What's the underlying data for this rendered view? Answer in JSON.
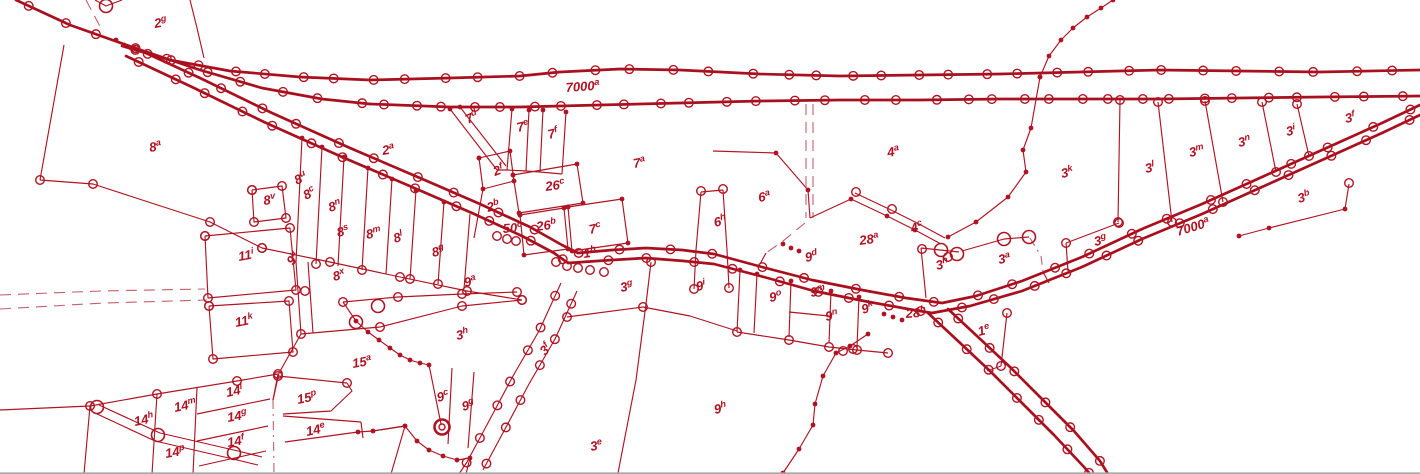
{
  "map": {
    "colors": {
      "background": "#ffffff",
      "line": "#a8101e",
      "thin": "#b01422",
      "dashed": "#c4616c",
      "text": "#b01323",
      "bottom_edge": "#a6a6a6"
    },
    "labels": [
      {
        "b": "2",
        "s": "g",
        "x": 155,
        "y": 28,
        "r": -10
      },
      {
        "b": "8",
        "s": "a",
        "x": 150,
        "y": 152,
        "r": -10
      },
      {
        "b": "2",
        "s": "a",
        "x": 383,
        "y": 155,
        "r": -10
      },
      {
        "b": "7",
        "s": "d",
        "x": 468,
        "y": 124,
        "r": -26
      },
      {
        "b": "7",
        "s": "e",
        "x": 518,
        "y": 132,
        "r": -14
      },
      {
        "b": "7",
        "s": "f",
        "x": 549,
        "y": 139,
        "r": -14
      },
      {
        "b": "7000",
        "s": "a",
        "x": 566,
        "y": 92,
        "r": -4,
        "fs": 14.5
      },
      {
        "b": "7",
        "s": "a",
        "x": 634,
        "y": 168,
        "r": -10
      },
      {
        "b": "4",
        "s": "a",
        "x": 888,
        "y": 157,
        "r": -10
      },
      {
        "b": "3",
        "s": "k",
        "x": 1062,
        "y": 178,
        "r": -12
      },
      {
        "b": "3",
        "s": "l",
        "x": 1146,
        "y": 173,
        "r": -12
      },
      {
        "b": "3",
        "s": "m",
        "x": 1190,
        "y": 157,
        "r": -12
      },
      {
        "b": "3",
        "s": "n",
        "x": 1239,
        "y": 147,
        "r": -12
      },
      {
        "b": "3",
        "s": "i",
        "x": 1287,
        "y": 136,
        "r": -12
      },
      {
        "b": "3",
        "s": "f",
        "x": 1346,
        "y": 123,
        "r": -12
      },
      {
        "b": "8",
        "s": "v",
        "x": 264,
        "y": 205,
        "r": -8
      },
      {
        "b": "8",
        "s": "u",
        "x": 297,
        "y": 185,
        "r": -28
      },
      {
        "b": "8",
        "s": "c",
        "x": 306,
        "y": 200,
        "r": -28
      },
      {
        "b": "8",
        "s": "n",
        "x": 330,
        "y": 212,
        "r": -18
      },
      {
        "b": "8",
        "s": "s",
        "x": 338,
        "y": 237,
        "r": -14
      },
      {
        "b": "8",
        "s": "m",
        "x": 367,
        "y": 239,
        "r": -12
      },
      {
        "b": "8",
        "s": "l",
        "x": 395,
        "y": 243,
        "r": -18
      },
      {
        "b": "8",
        "s": "g",
        "x": 433,
        "y": 257,
        "r": -14
      },
      {
        "b": "2",
        "s": "f",
        "x": 495,
        "y": 176,
        "r": -20
      },
      {
        "b": "26",
        "s": "c",
        "x": 546,
        "y": 191,
        "r": -8
      },
      {
        "b": "2",
        "s": "b",
        "x": 488,
        "y": 212,
        "r": -14
      },
      {
        "b": "26",
        "s": "b",
        "x": 537,
        "y": 231,
        "r": -8
      },
      {
        "b": "50",
        "s": "c",
        "x": 503,
        "y": 233,
        "r": -4,
        "fs": 12.5
      },
      {
        "b": "7",
        "s": "c",
        "x": 590,
        "y": 234,
        "r": -12
      },
      {
        "b": "1",
        "s": "b",
        "x": 584,
        "y": 258,
        "r": -8
      },
      {
        "b": "6",
        "s": "h",
        "x": 715,
        "y": 227,
        "r": -14
      },
      {
        "b": "6",
        "s": "a",
        "x": 759,
        "y": 202,
        "r": -10
      },
      {
        "b": "28",
        "s": "a",
        "x": 860,
        "y": 245,
        "r": -8
      },
      {
        "b": "4",
        "s": "c",
        "x": 912,
        "y": 233,
        "r": -16
      },
      {
        "b": "9",
        "s": "d",
        "x": 806,
        "y": 262,
        "r": -12,
        "fs": 12.5
      },
      {
        "b": "3",
        "s": "g",
        "x": 1095,
        "y": 246,
        "r": -12
      },
      {
        "b": "7000",
        "s": "a",
        "x": 1178,
        "y": 236,
        "r": -17,
        "fs": 14.5
      },
      {
        "b": "3",
        "s": "b",
        "x": 1299,
        "y": 203,
        "r": -16
      },
      {
        "b": "3",
        "s": "h",
        "x": 937,
        "y": 270,
        "r": -14
      },
      {
        "b": "3",
        "s": "a",
        "x": 999,
        "y": 264,
        "r": -10
      },
      {
        "b": "1",
        "s": "e",
        "x": 979,
        "y": 336,
        "r": -14
      },
      {
        "b": "11",
        "s": "i",
        "x": 239,
        "y": 261,
        "r": -10
      },
      {
        "b": "9",
        "s": "u",
        "x": 293,
        "y": 266,
        "r": -55,
        "fs": 12.5
      },
      {
        "b": "8",
        "s": "x",
        "x": 334,
        "y": 281,
        "r": -14
      },
      {
        "b": "9",
        "s": "a",
        "x": 465,
        "y": 287,
        "r": -12
      },
      {
        "b": "11",
        "s": "k",
        "x": 236,
        "y": 327,
        "r": -12
      },
      {
        "b": "15",
        "s": "a",
        "x": 353,
        "y": 368,
        "r": -10
      },
      {
        "b": "3",
        "s": "h",
        "x": 457,
        "y": 340,
        "r": -12
      },
      {
        "b": "3",
        "s": "f",
        "x": 545,
        "y": 356,
        "r": -46
      },
      {
        "b": "3",
        "s": "g",
        "x": 621,
        "y": 292,
        "r": -10
      },
      {
        "b": "9",
        "s": "i",
        "x": 697,
        "y": 291,
        "r": -12
      },
      {
        "b": "9",
        "s": "o",
        "x": 770,
        "y": 302,
        "r": -10
      },
      {
        "b": "9",
        "s": "m",
        "x": 811,
        "y": 297,
        "r": -10
      },
      {
        "b": "9",
        "s": "n",
        "x": 826,
        "y": 321,
        "r": -10
      },
      {
        "b": "9",
        "s": "k",
        "x": 863,
        "y": 314,
        "r": -18
      },
      {
        "b": "28",
        "s": "b",
        "x": 906,
        "y": 318,
        "r": -4,
        "fs": 12.5
      },
      {
        "b": "9",
        "s": "c",
        "x": 438,
        "y": 402,
        "r": -14
      },
      {
        "b": "9",
        "s": "g",
        "x": 463,
        "y": 411,
        "r": -14
      },
      {
        "b": "15",
        "s": "p",
        "x": 298,
        "y": 404,
        "r": -12
      },
      {
        "b": "14",
        "s": "l",
        "x": 227,
        "y": 397,
        "r": -12
      },
      {
        "b": "14",
        "s": "m",
        "x": 175,
        "y": 412,
        "r": -12
      },
      {
        "b": "14",
        "s": "h",
        "x": 135,
        "y": 426,
        "r": -12
      },
      {
        "b": "14",
        "s": "g",
        "x": 228,
        "y": 422,
        "r": -10
      },
      {
        "b": "14",
        "s": "f",
        "x": 228,
        "y": 447,
        "r": -10
      },
      {
        "b": "14",
        "s": "p",
        "x": 166,
        "y": 458,
        "r": -10
      },
      {
        "b": "14",
        "s": "e",
        "x": 307,
        "y": 436,
        "r": -12
      },
      {
        "b": "3",
        "s": "e",
        "x": 591,
        "y": 451,
        "r": -10
      },
      {
        "b": "9",
        "s": "h",
        "x": 715,
        "y": 414,
        "r": -12
      }
    ]
  }
}
